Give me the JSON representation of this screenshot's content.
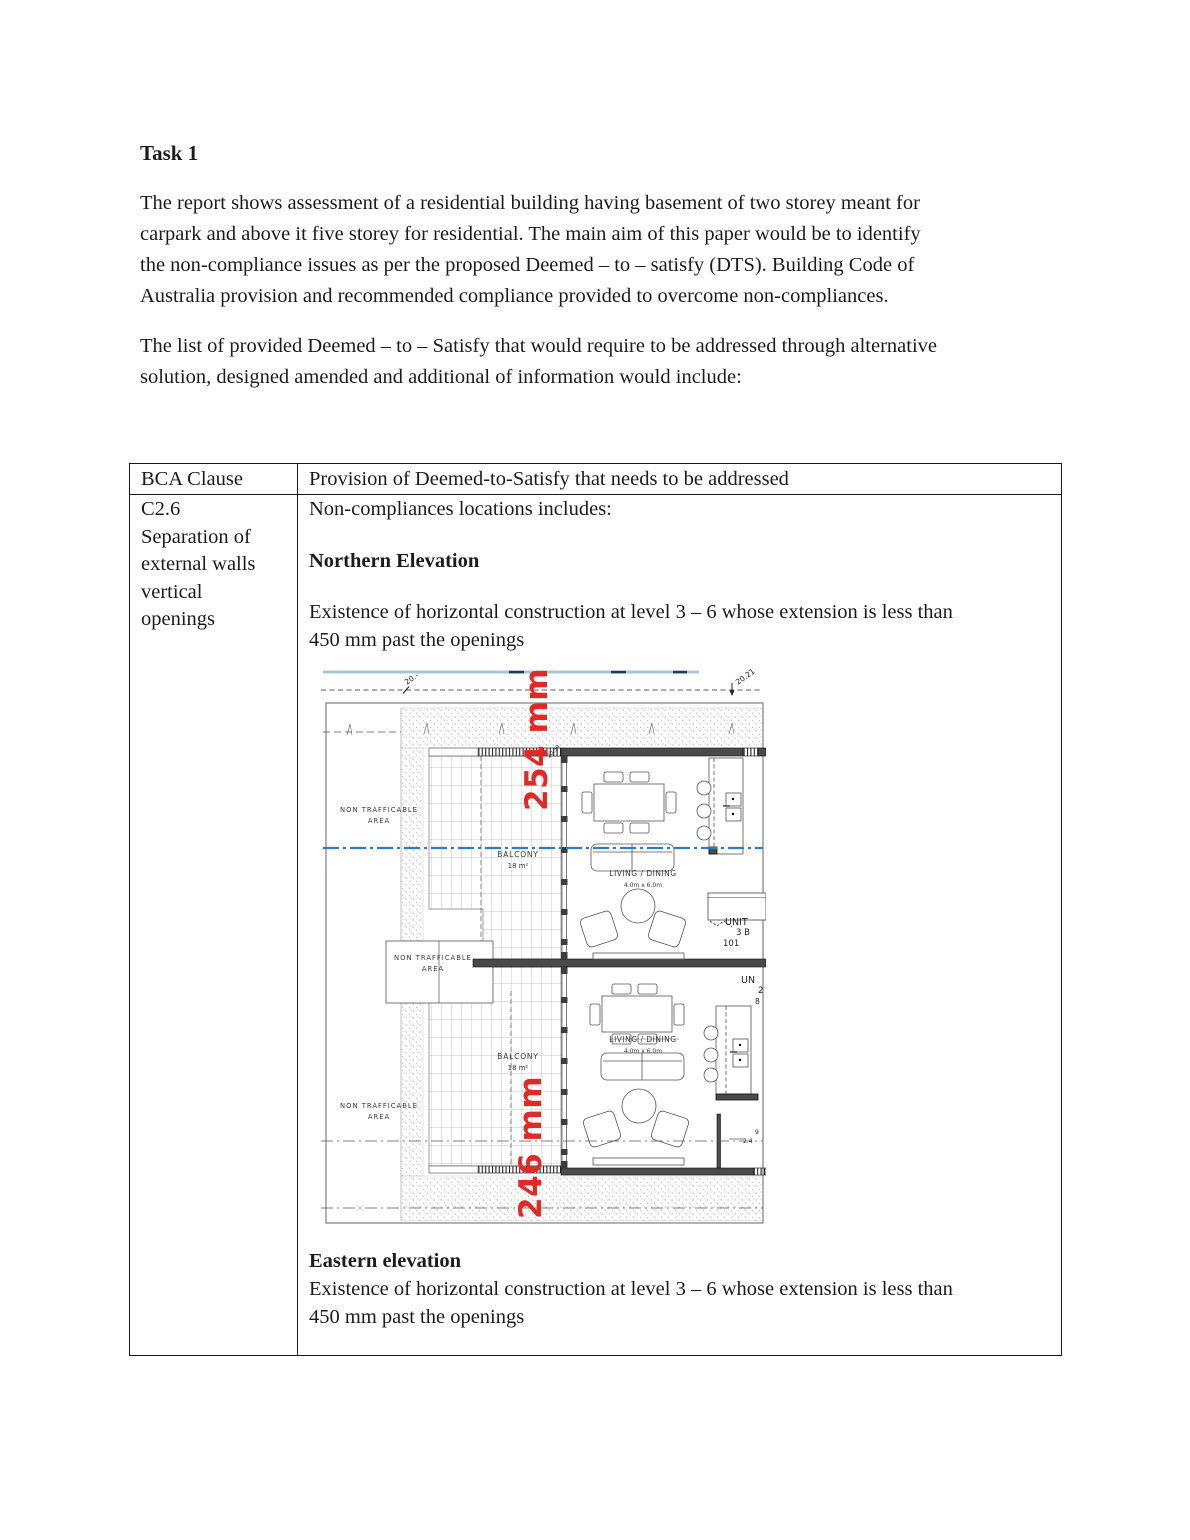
{
  "page": {
    "title": "Task 1",
    "paragraph1_lines": [
      "The report shows assessment of a residential building having basement of two storey meant for",
      "carpark and above it five storey for residential. The main aim of this paper would be to identify",
      "the non-compliance issues as per the proposed Deemed – to – satisfy (DTS). Building Code of",
      "Australia provision and recommended compliance provided to overcome non-compliances."
    ],
    "paragraph2_lines": [
      "The list of provided Deemed – to – Satisfy that would require to be addressed through alternative",
      "solution, designed amended and additional of information would include:"
    ]
  },
  "table": {
    "header": {
      "col1": "BCA Clause",
      "col2": "Provision of Deemed-to-Satisfy that needs to be addressed"
    },
    "row": {
      "clause_lines": [
        "C2.6",
        "Separation of",
        "external walls",
        "vertical",
        "openings"
      ],
      "intro": "Non-compliances locations includes:",
      "northern_heading": "Northern Elevation",
      "northern_body_lines": [
        "Existence of horizontal construction at level 3 – 6 whose extension is less than",
        "450 mm past the openings"
      ],
      "eastern_heading": "Eastern elevation",
      "eastern_body_lines": [
        "Existence of horizontal construction at level 3 – 6 whose extension is less than",
        "450 mm past the openings"
      ]
    }
  },
  "floorplan": {
    "dim_left": "20.-",
    "dim_right": "20.21",
    "wall_dim": "20.59",
    "red_dim_top": "254 mm",
    "red_dim_bottom": "246 mm",
    "non_trafficable_line1": "NON TRAFFICABLE",
    "non_trafficable_line2": "AREA",
    "balcony_label": "BALCONY",
    "balcony_area": "18 m²",
    "living_label": "LIVING / DINING",
    "living_size": "4.0m x 6.0m",
    "unit1_name": "UNIT",
    "unit1_beds": "3 B",
    "unit1_number": "101",
    "unit2_name": "UN",
    "unit2_line2": "2",
    "unit2_line3": "8",
    "small_dim_a": "9",
    "small_dim_b": "2.4",
    "colors": {
      "red_annotation": "#e02a26",
      "blue_top_line": "#a9c4d7",
      "blue_dashdot": "#2f7cc4",
      "wall_fill": "#4a4a4a"
    }
  }
}
